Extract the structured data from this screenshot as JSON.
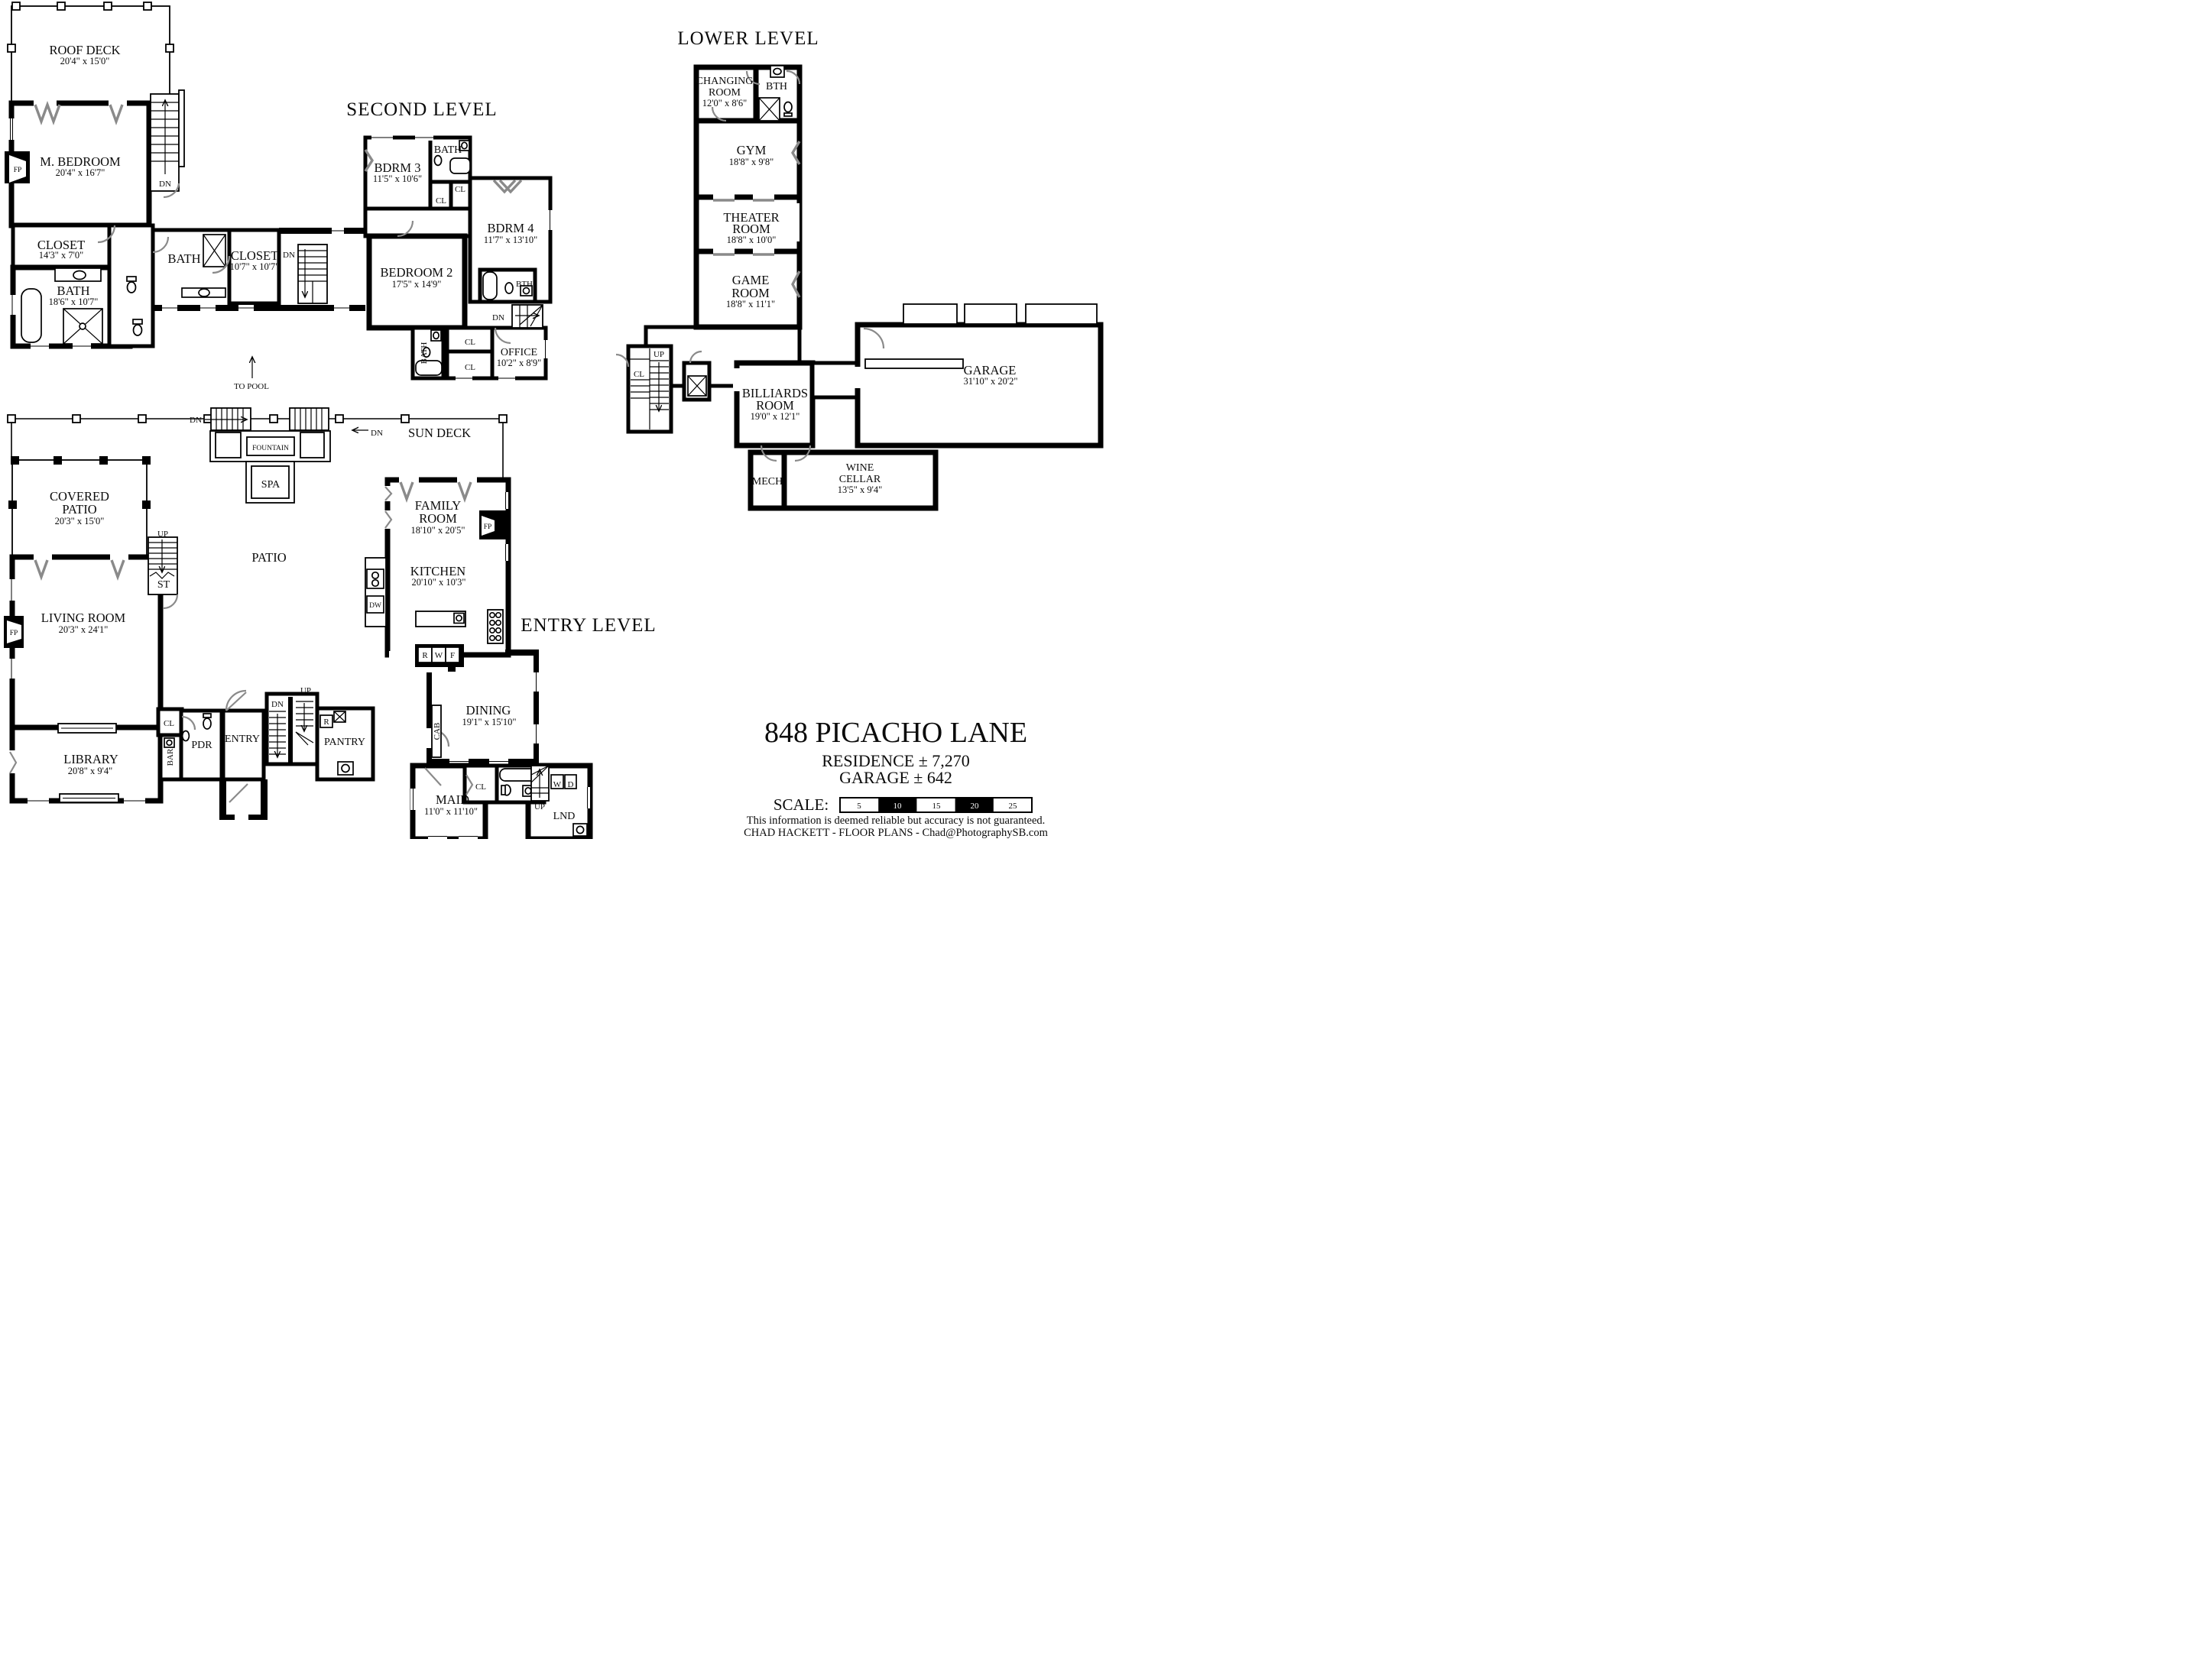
{
  "page": {
    "background": "#ffffff",
    "ink": "#000000",
    "door_color": "#8a8a8a"
  },
  "levels": {
    "second": {
      "title": "SECOND LEVEL",
      "rooms": {
        "roof_deck": {
          "name": "ROOF DECK",
          "dims": "20'4\" x 15'0\""
        },
        "m_bedroom": {
          "name": "M. BEDROOM",
          "dims": "20'4\" x 16'7\""
        },
        "closet_master": {
          "name": "CLOSET",
          "dims": "14'3\" x 7'0\""
        },
        "bath_master": {
          "name": "BATH",
          "dims": "18'6\" x 10'7\""
        },
        "bath_hall": {
          "name": "BATH"
        },
        "closet_hall": {
          "name": "CLOSET",
          "dims": "10'7\" x 10'7\""
        },
        "bdrm3": {
          "name": "BDRM 3",
          "dims": "11'5\" x 10'6\""
        },
        "bath3": {
          "name": "BATH"
        },
        "bdrm4": {
          "name": "BDRM 4",
          "dims": "11'7\" x 13'10\""
        },
        "bedroom2": {
          "name": "BEDROOM 2",
          "dims": "17'5\" x 14'9\""
        },
        "bth": {
          "name": "BTH"
        },
        "bath_bed2": {
          "name": "BATH"
        },
        "office": {
          "name": "OFFICE",
          "dims": "10'2\" x 8'9\""
        }
      },
      "notes": {
        "to_pool": "TO POOL"
      }
    },
    "lower": {
      "title": "LOWER LEVEL",
      "rooms": {
        "changing": {
          "line1": "CHANGING",
          "line2": "ROOM",
          "dims": "12'0\" x 8'6\""
        },
        "bth": {
          "name": "BTH"
        },
        "gym": {
          "name": "GYM",
          "dims": "18'8\" x 9'8\""
        },
        "theater": {
          "line1": "THEATER",
          "line2": "ROOM",
          "dims": "18'8\" x 10'0\""
        },
        "game": {
          "line1": "GAME",
          "line2": "ROOM",
          "dims": "18'8\" x 11'1\""
        },
        "billiards": {
          "line1": "BILLIARDS",
          "line2": "ROOM",
          "dims": "19'0\" x 12'1\""
        },
        "garage": {
          "name": "GARAGE",
          "dims": "31'10\" x 20'2\""
        },
        "mech": {
          "name": "MECH"
        },
        "wine_cellar": {
          "line1": "WINE",
          "line2": "CELLAR",
          "dims": "13'5\" x 9'4\""
        }
      }
    },
    "entry": {
      "title": "ENTRY LEVEL",
      "rooms": {
        "covered_patio": {
          "line1": "COVERED",
          "line2": "PATIO",
          "dims": "20'3\" x 15'0\""
        },
        "living_room": {
          "name": "LIVING ROOM",
          "dims": "20'3\" x 24'1\""
        },
        "library": {
          "name": "LIBRARY",
          "dims": "20'8\" x 9'4\""
        },
        "patio": {
          "name": "PATIO"
        },
        "spa": {
          "name": "SPA"
        },
        "fountain": {
          "name": "FOUNTAIN"
        },
        "sun_deck": {
          "name": "SUN DECK"
        },
        "family_room": {
          "line1": "FAMILY",
          "line2": "ROOM",
          "dims": "18'10\" x 20'5\""
        },
        "kitchen": {
          "name": "KITCHEN",
          "dims": "20'10\" x 10'3\""
        },
        "dining": {
          "name": "DINING",
          "dims": "19'1\" x 15'10\""
        },
        "pantry": {
          "name": "PANTRY"
        },
        "entry": {
          "name": "ENTRY"
        },
        "pdr": {
          "name": "PDR"
        },
        "bar": {
          "name": "BAR"
        },
        "maid": {
          "name": "MAID",
          "dims": "11'0\" x 11'10\""
        },
        "lnd": {
          "name": "LND"
        }
      }
    }
  },
  "glyphs": {
    "fp": "FP",
    "dn": "DN",
    "up": "UP",
    "cl": "CL",
    "st": "ST",
    "dw": "DW",
    "cab": "CAB",
    "r": "R",
    "w": "W",
    "d": "D",
    "f": "F"
  },
  "title_block": {
    "address": "848 PICACHO LANE",
    "residence": "RESIDENCE ± 7,270",
    "garage": "GARAGE ± 642",
    "scale_label": "SCALE:",
    "scale_ticks": [
      "5",
      "10",
      "15",
      "20",
      "25"
    ],
    "disclaimer": "This information is deemed reliable but accuracy is not guaranteed.",
    "credit": "CHAD HACKETT - FLOOR PLANS - Chad@PhotographySB.com"
  }
}
